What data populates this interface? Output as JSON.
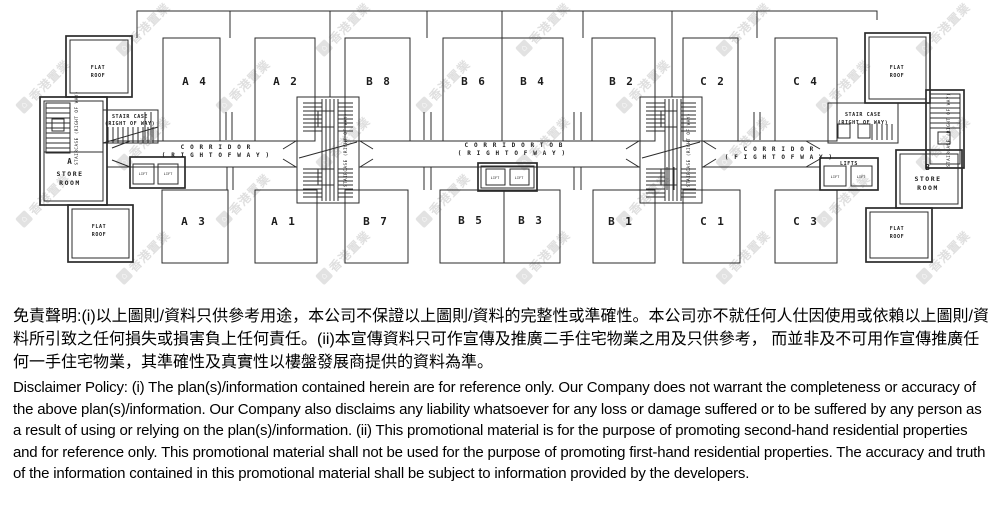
{
  "watermark": {
    "text": "香港置業",
    "logo_glyph": "⌂"
  },
  "plan": {
    "units": [
      {
        "id": "A4",
        "label": "A 4"
      },
      {
        "id": "A2",
        "label": "A 2"
      },
      {
        "id": "B8",
        "label": "B 8"
      },
      {
        "id": "B6",
        "label": "B 6"
      },
      {
        "id": "B4",
        "label": "B 4"
      },
      {
        "id": "B2",
        "label": "B 2"
      },
      {
        "id": "C2",
        "label": "C 2"
      },
      {
        "id": "C4",
        "label": "C 4"
      },
      {
        "id": "A3",
        "label": "A 3"
      },
      {
        "id": "A1",
        "label": "A 1"
      },
      {
        "id": "B7",
        "label": "B 7"
      },
      {
        "id": "B5",
        "label": "B 5"
      },
      {
        "id": "B3",
        "label": "B 3"
      },
      {
        "id": "B1",
        "label": "B 1"
      },
      {
        "id": "C1",
        "label": "C 1"
      },
      {
        "id": "C3",
        "label": "C 3"
      }
    ],
    "flat_roof": {
      "line1": "FLAT",
      "line2": "ROOF"
    },
    "store_room_a": {
      "line1": "A",
      "line2": "STORE",
      "line3": "ROOM"
    },
    "store_room_b": {
      "line1": "B",
      "line2": "STORE",
      "line3": "ROOM"
    },
    "staircase": {
      "line1": "STAIR CASE",
      "line2": "(RIGHT OF WAY)",
      "vertical": "STAIRCASE (RIGHT OF WAY)"
    },
    "lifts": {
      "label": "LIFTS",
      "box_label": "LIFT"
    },
    "corridor": {
      "left_line1": "C O R R I D O R",
      "left_line2": "( R I G H T  O F  W A Y )",
      "center_line1": "C O R R I D O R   T O   B",
      "center_line2": "( R I G H T  O F  W A Y )",
      "right_line1": "C O R R I D O R",
      "right_line2": "( F I G H T   O F   W A Y )"
    }
  },
  "disclaimer": {
    "zh": "免責聲明:(i)以上圖則/資料只供參考用途，本公司不保證以上圖則/資料的完整性或準確性。本公司亦不就任何人仕因使用或依賴以上圖則/資料所引致之任何損失或損害負上任何責任。(ii)本宣傳資料只可作宣傳及推廣二手住宅物業之用及只供參考， 而並非及不可用作宣傳推廣任何一手住宅物業，其準確性及真實性以樓盤發展商提供的資料為準。",
    "en": "Disclaimer Policy: (i) The plan(s)/information contained herein are for reference only. Our Company does not warrant the completeness or accuracy of the above plan(s)/information. Our Company also disclaims any liability whatsoever for any loss or damage suffered or to be suffered by any person as a result of using or relying on the plan(s)/information. (ii) This promotional material is for the purpose of promoting second-hand residential properties and for reference only. This promotional material shall not be used for the purpose of promoting first-hand residential properties. The accuracy and truth of the information contained in this promotional material shall be subject to information provided by the developers."
  }
}
